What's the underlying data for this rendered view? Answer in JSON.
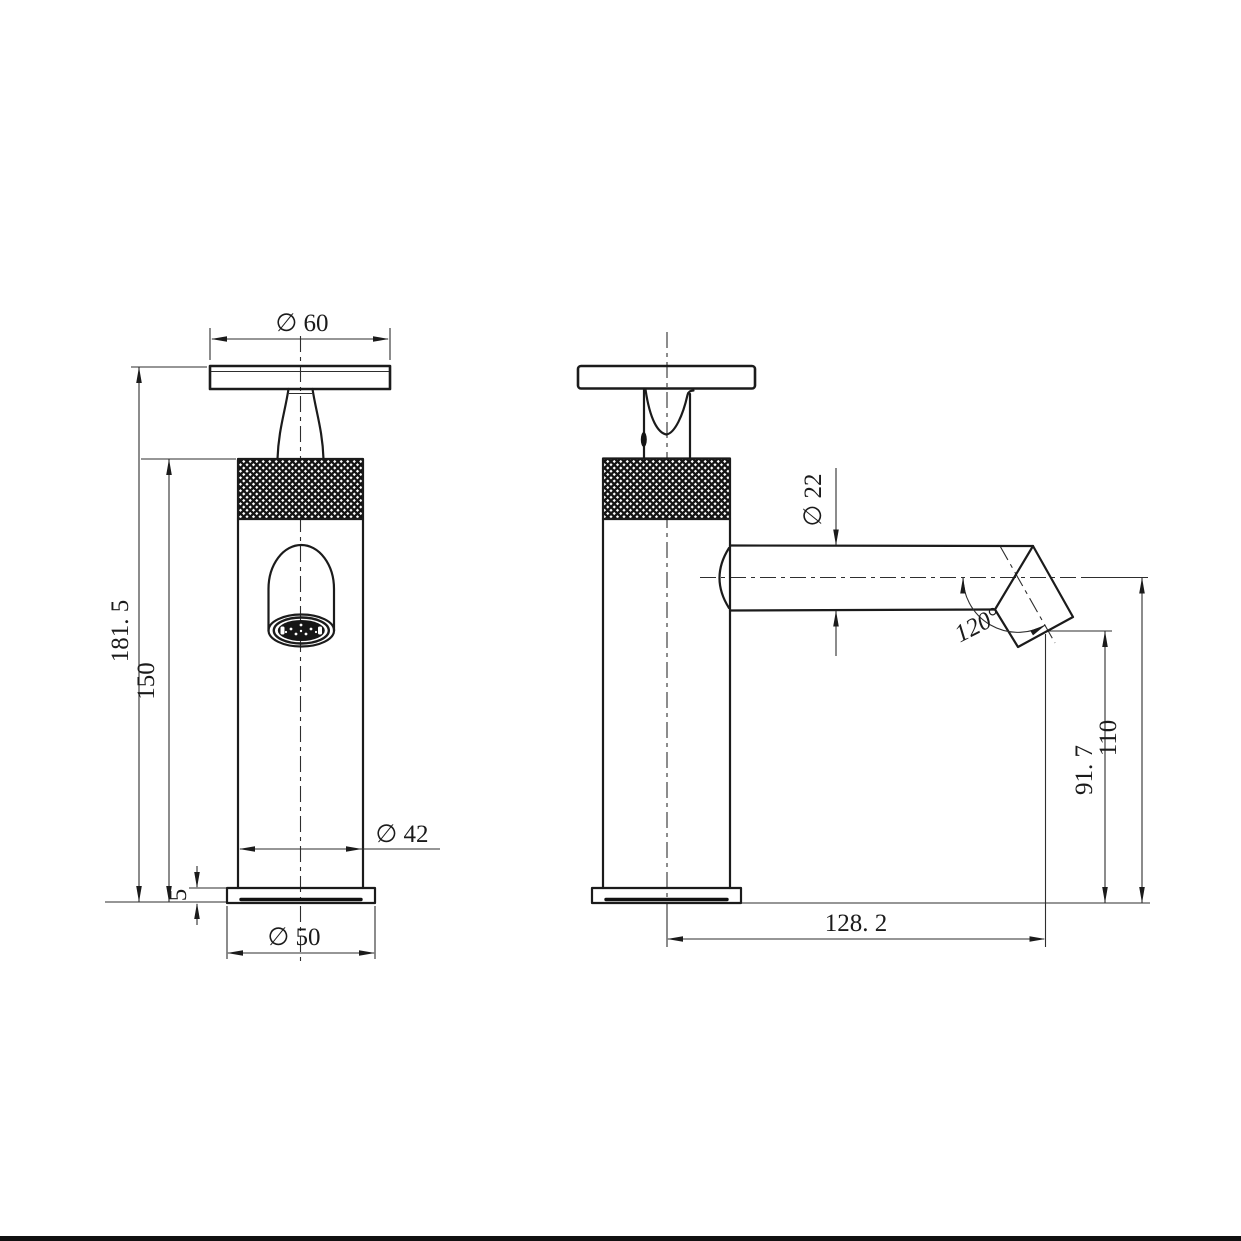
{
  "drawing": {
    "description": "technical-drawing-basin-tap-two-views",
    "views": {
      "front": "front-view",
      "side": "side-view"
    },
    "colors": {
      "line": "#1b1b1b",
      "thin_line": "#2e2e2e",
      "background": "#ffffff"
    }
  },
  "dimensions": {
    "handle_diameter": {
      "label": "∅ 60"
    },
    "overall_height": {
      "label": "181. 5"
    },
    "body_height": {
      "label": "150"
    },
    "body_diameter": {
      "label": "∅ 42"
    },
    "base_thickness": {
      "label": "5"
    },
    "base_diameter": {
      "label": "∅ 50"
    },
    "spout_diameter": {
      "label": "∅ 22"
    },
    "spout_angle": {
      "label": "120°"
    },
    "outlet_height": {
      "label": "91. 7"
    },
    "spout_axis_height": {
      "label": "110"
    },
    "spout_reach": {
      "label": "128. 2"
    }
  }
}
